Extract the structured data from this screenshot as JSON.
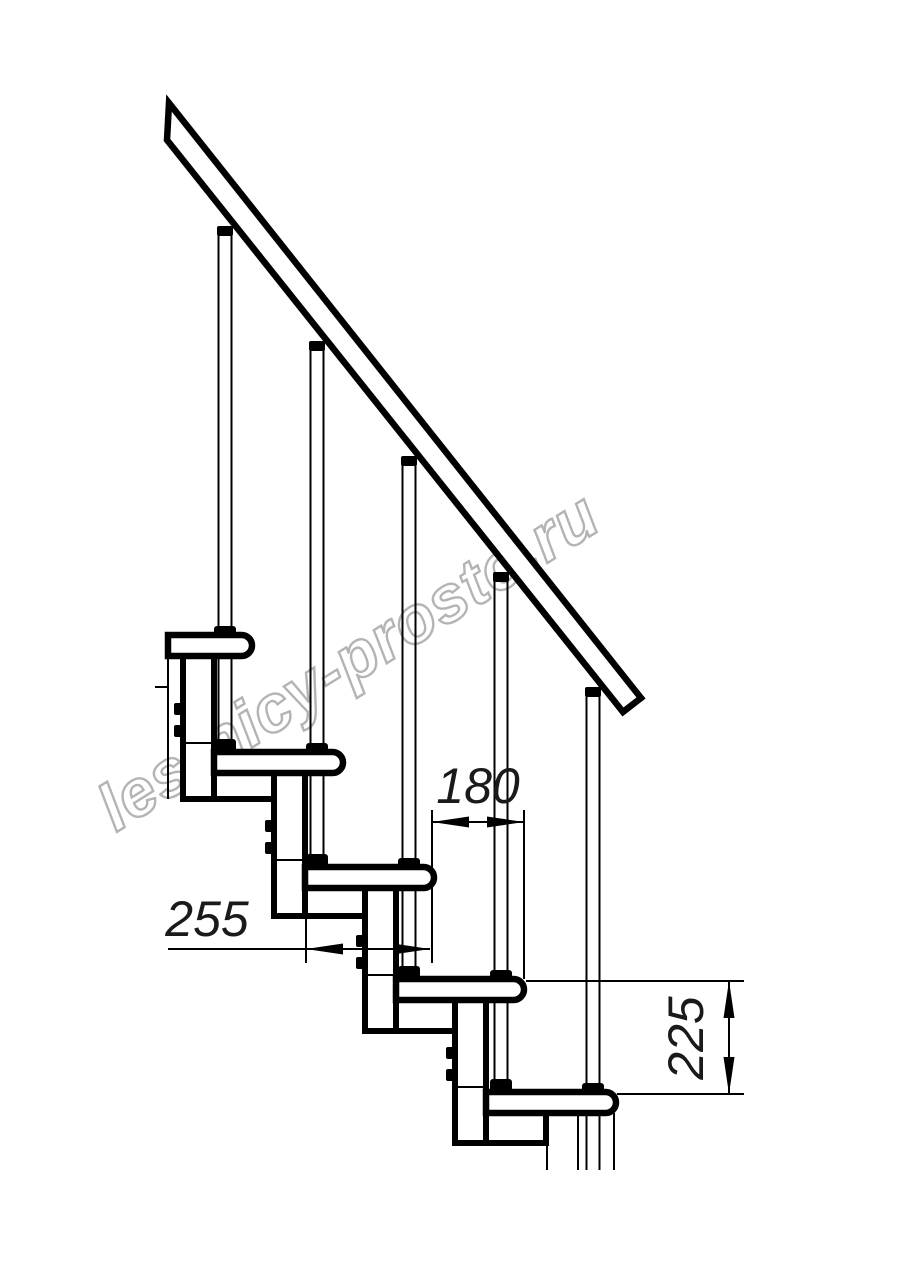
{
  "drawing": {
    "description": "Technical side-view drawing of a modular staircase with handrail",
    "background_color": "#ffffff",
    "line_color": "#000000",
    "watermark": {
      "text": "lestnicy-prosto.ru",
      "color": "#b4b4b4",
      "rotation_deg": -32
    },
    "dimensions": [
      {
        "name": "step-going",
        "value": "180",
        "orientation": "horizontal"
      },
      {
        "name": "tread-depth",
        "value": "255",
        "orientation": "horizontal"
      },
      {
        "name": "step-rise",
        "value": "225",
        "orientation": "vertical"
      }
    ],
    "elements": {
      "treads": 5,
      "balusters": 5,
      "spine_modules": 5,
      "handrail": "sloped, cut at both ends"
    }
  }
}
